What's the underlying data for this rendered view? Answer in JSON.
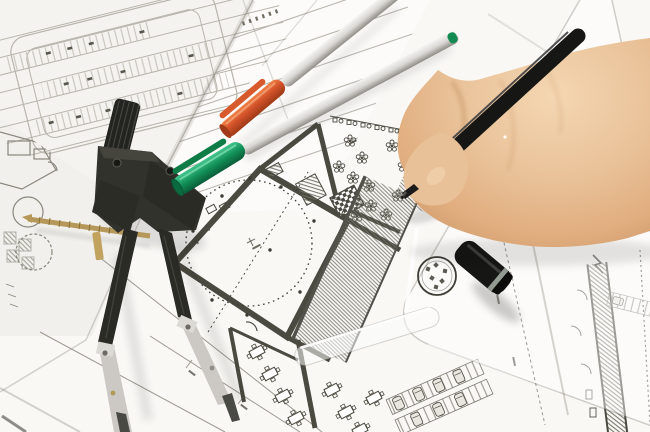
{
  "meta": {
    "type": "photograph",
    "description": "Overhead close-up photo of an architect's desk: a right hand holding a black fineliner pen annotates a floor plan; overlapping white blueprint sheets show a circular hall plan, a tree courtyard, seating tables, parking rows and hatched walls; a drafting divider compass lies at left, silver pens with orange and green caps lie across the sheets, and a black pen cap rests on a transparent set-square ruler bearing a circular logo stamp."
  },
  "objects": {
    "sheets": {
      "label": "overlapping architectural drawing sheets"
    },
    "main_plan": {
      "label": "floor plan with round hall, tree courtyard, tables and hatched walls"
    },
    "site_plan": {
      "label": "parking site plan sheet"
    },
    "ruled_sheet": {
      "label": "sheet with ruled guide lines and tiny annotations"
    },
    "left_plan": {
      "label": "partial floor plan sheet at left edge"
    },
    "compass": {
      "label": "drafting divider compass with brass adjusting screw"
    },
    "orange_pen": {
      "label": "silver pen with orange cap"
    },
    "green_pen": {
      "label": "silver pen with green cap"
    },
    "black_pen": {
      "label": "black fineliner pen held in hand"
    },
    "pen_cap": {
      "label": "black pen cap with metal ring"
    },
    "ruler": {
      "label": "transparent set-square ruler with circular logo stamp"
    },
    "scale_strip": {
      "label": "transparent ruler edge strip across the plan"
    },
    "hand": {
      "label": "right hand gripping the pen"
    }
  },
  "colors": {
    "paper": "#f9f8f5",
    "paper_tint": "#f3f2ee",
    "paper_ruled": "#fcfbf9",
    "edge_shadow": "#b9b5ac",
    "plan_light": "#b7b4ab",
    "plan_mid": "#8f8d82",
    "plan_dark": "#4b4a40",
    "hatch": "#6e6d60",
    "brass": "#b6985a",
    "compass_dark": "#32322c",
    "compass_metal": "#ccc9c4",
    "barrel_silver": "#d9d7d3",
    "cap_orange": "#d4532a",
    "cap_orange_deep": "#9e3a16",
    "cap_green": "#129159",
    "cap_green_deep": "#0a5c38",
    "pen_black": "#161614",
    "cap_ring": "#939b92",
    "skin_light": "#f4d7b2",
    "skin_base": "#e5b88e",
    "skin_shadow": "#c08a5e",
    "logo_ink": "#3f3e36"
  }
}
